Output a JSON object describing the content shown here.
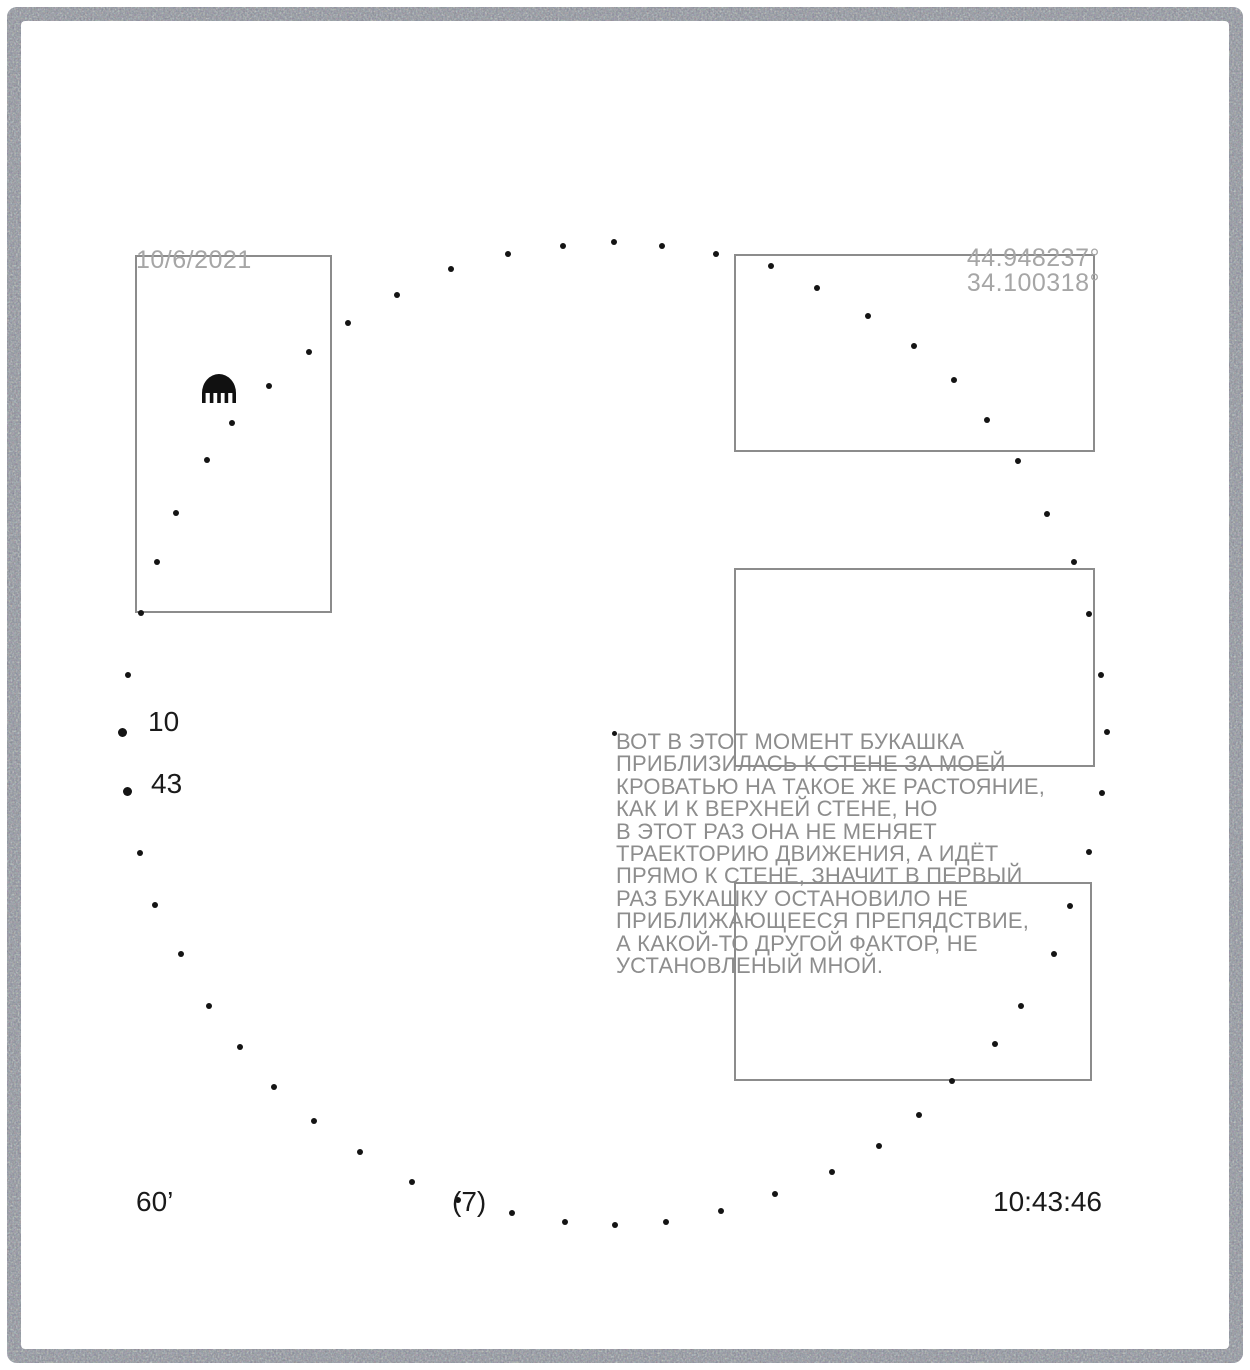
{
  "header": {
    "date": "10/6/2021",
    "latitude": "44.948237°",
    "longitude": "34.100318°"
  },
  "pause_labels": {
    "first": "10",
    "second": "43"
  },
  "annotation": {
    "text": "ВОТ В ЭТОТ МОМЕНТ БУКАШКА\nПРИБЛИЗИЛАСЬ К СТЕНЕ ЗА МОЕЙ\nКРОВАТЬЮ НА ТАКОЕ ЖЕ РАСТОЯНИЕ,\nКАК И К ВЕРХНЕЙ СТЕНЕ, НО\nВ ЭТОТ РАЗ ОНА НЕ МЕНЯЕТ\nТРАЕКТОРИЮ ДВИЖЕНИЯ, А ИДЁТ\nПРЯМО К СТЕНЕ, ЗНАЧИТ В ПЕРВЫЙ\nРАЗ БУКАШКУ ОСТАНОВИЛО НЕ\nПРИБЛИЖАЮЩЕЕСЯ ПРЕПЯДСТВИЕ,\nА КАКОЙ-ТО ДРУГОЙ ФАКТОР, НЕ\nУСТАНОВЛЕНЫЙ МНОЙ."
  },
  "footer": {
    "duration": "60’",
    "marker": "(7)",
    "time": "10:43:46"
  },
  "icons": {
    "bug": "bug-icon"
  },
  "colors": {
    "ink": "#1a1a1a",
    "muted_text": "#a6a6a6",
    "annotation_text": "#8d8d8d",
    "frame_border": "#8c8c8c",
    "dot": "#141414",
    "border_ring": "#878d99"
  },
  "frames": [
    {
      "x": 135,
      "y": 255,
      "w": 197,
      "h": 358
    },
    {
      "x": 734,
      "y": 254,
      "w": 361,
      "h": 198
    },
    {
      "x": 734,
      "y": 568,
      "w": 361,
      "h": 199
    },
    {
      "x": 734,
      "y": 882,
      "w": 358,
      "h": 199
    }
  ],
  "trajectory": {
    "default_radius": 3,
    "points": [
      [
        141,
        613
      ],
      [
        157,
        562
      ],
      [
        176,
        513
      ],
      [
        207,
        460
      ],
      [
        232,
        423
      ],
      [
        269,
        386
      ],
      [
        309,
        352
      ],
      [
        348,
        323
      ],
      [
        397,
        295
      ],
      [
        451,
        269
      ],
      [
        508,
        254
      ],
      [
        563,
        246
      ],
      [
        614,
        242
      ],
      [
        662,
        246
      ],
      [
        716,
        254
      ],
      [
        771,
        266
      ],
      [
        817,
        288
      ],
      [
        868,
        316
      ],
      [
        914,
        346
      ],
      [
        954,
        380
      ],
      [
        987,
        420
      ],
      [
        1018,
        461
      ],
      [
        1047,
        514
      ],
      [
        1074,
        562
      ],
      [
        1089,
        614
      ],
      [
        1101,
        675
      ],
      [
        1107,
        732
      ],
      [
        1102,
        793
      ],
      [
        1089,
        852
      ],
      [
        1070,
        906
      ],
      [
        1054,
        954
      ],
      [
        1021,
        1006
      ],
      [
        995,
        1044
      ],
      [
        952,
        1081
      ],
      [
        919,
        1115
      ],
      [
        879,
        1146
      ],
      [
        832,
        1172
      ],
      [
        775,
        1194
      ],
      [
        721,
        1211
      ],
      [
        666,
        1222
      ],
      [
        615,
        1225
      ],
      [
        565,
        1222
      ],
      [
        512,
        1213
      ],
      [
        458,
        1200
      ],
      [
        412,
        1182
      ],
      [
        360,
        1152
      ],
      [
        314,
        1121
      ],
      [
        274,
        1087
      ],
      [
        240,
        1047
      ],
      [
        209,
        1006
      ],
      [
        181,
        954
      ],
      [
        155,
        905
      ],
      [
        140,
        853
      ],
      [
        127,
        791,
        4.5
      ],
      [
        122,
        732,
        4.5
      ],
      [
        128,
        675
      ],
      [
        614,
        733,
        2.5
      ]
    ]
  }
}
